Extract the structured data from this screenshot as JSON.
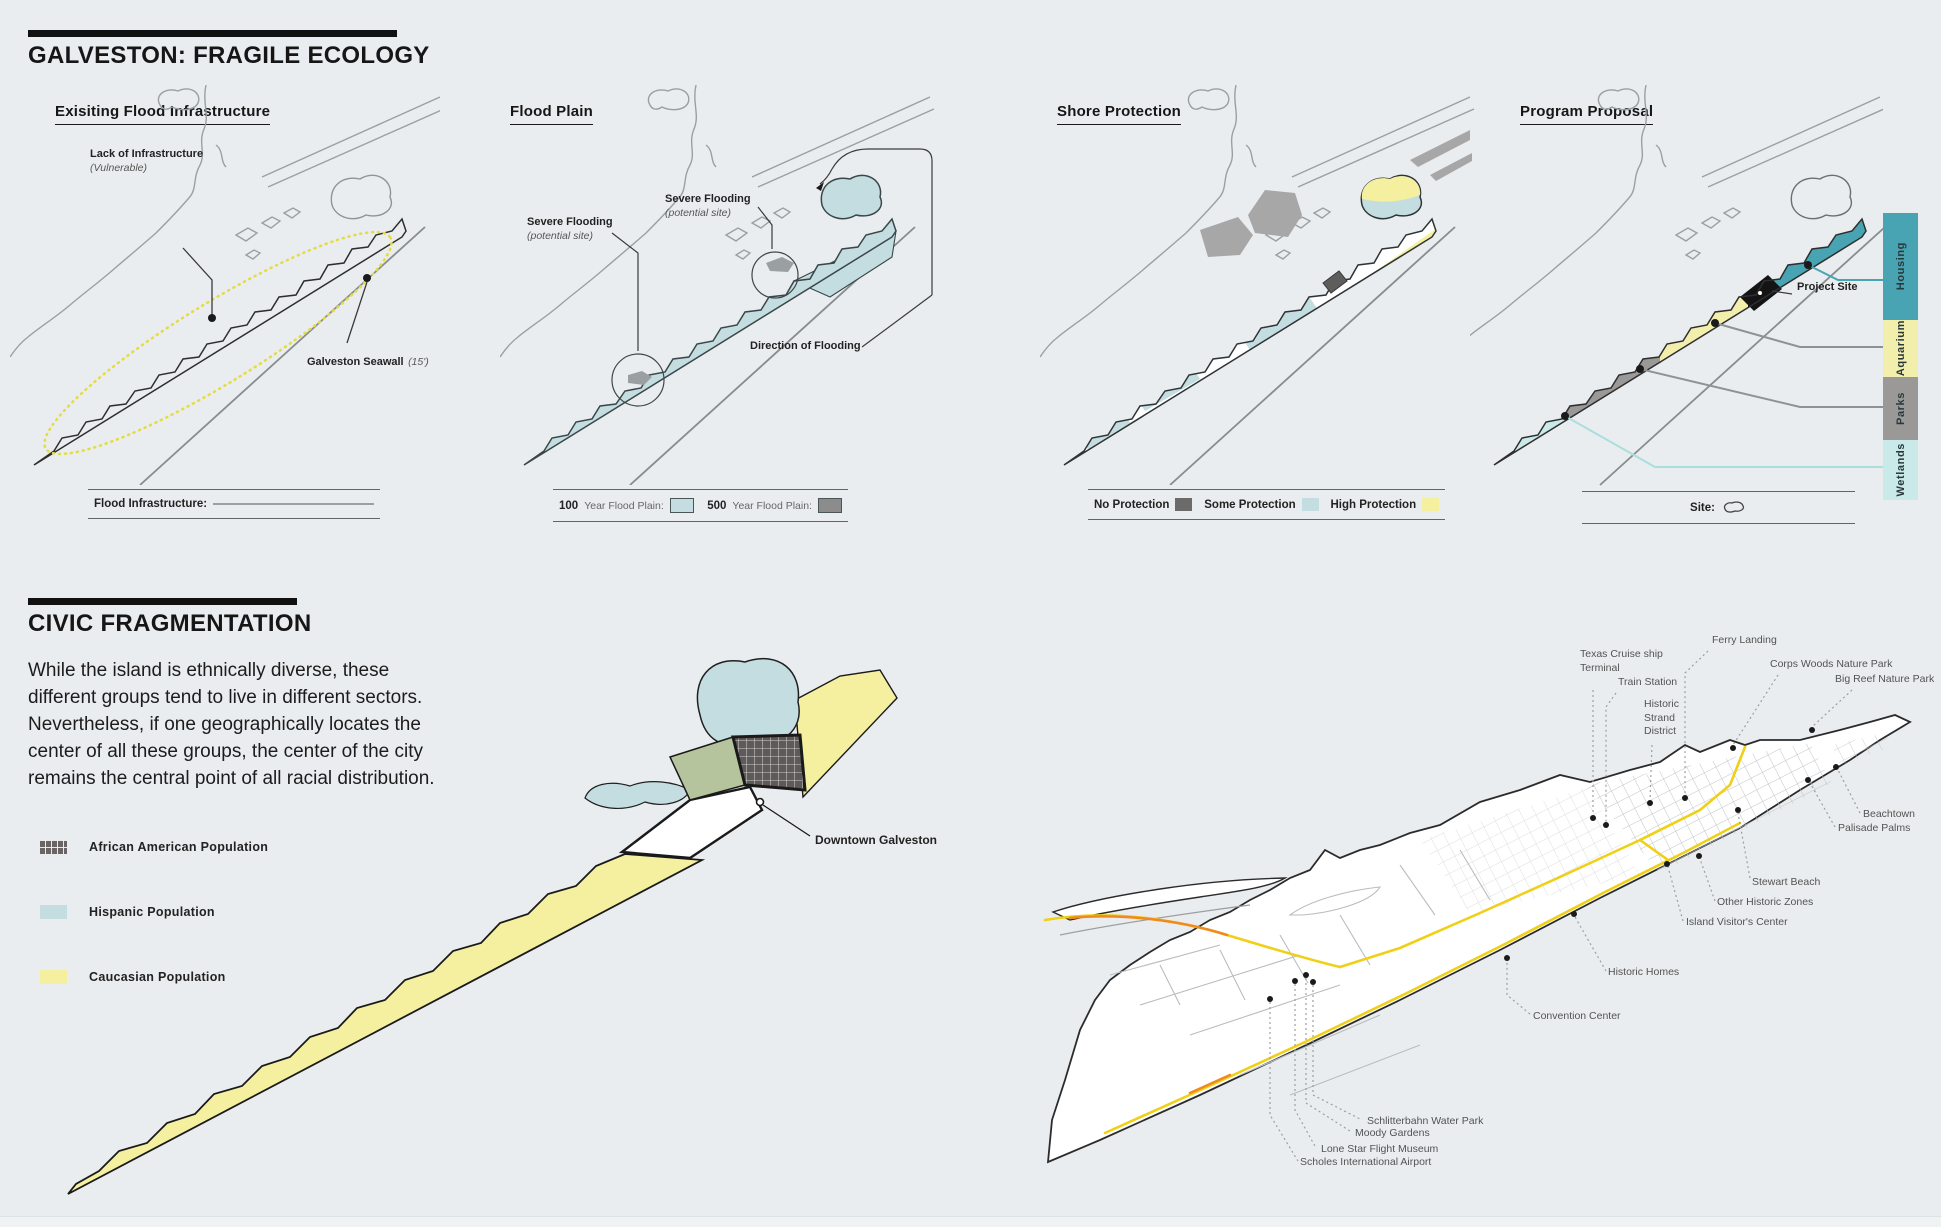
{
  "page": {
    "bg": "#eaedef"
  },
  "ecology": {
    "title": "GALVESTON: FRAGILE ECOLOGY",
    "flood_infrastructure": {
      "title": "Exisiting Flood Infrastructure",
      "lack_label": "Lack of Infrastructure",
      "lack_note": "(Vulnerable)",
      "seawall_label": "Galveston Seawall",
      "seawall_note": "(15')",
      "legend_label": "Flood Infrastructure:"
    },
    "flood_plain": {
      "title": "Flood Plain",
      "severe_label": "Severe Flooding",
      "severe_note": "(potential site)",
      "severe2_label": "Severe Flooding",
      "severe2_note": "(potential site)",
      "direction_label": "Direction of Flooding",
      "legend": [
        {
          "num": "100",
          "label": "Year Flood Plain:",
          "color": "#c3dde0"
        },
        {
          "num": "500",
          "label": "Year Flood Plain:",
          "color": "#8c8c8c"
        }
      ]
    },
    "shore_protection": {
      "title": "Shore Protection",
      "legend": [
        {
          "label": "No Protection",
          "color": "#6d6a6a"
        },
        {
          "label": "Some Protection",
          "color": "#c3dde0"
        },
        {
          "label": "High Protection",
          "color": "#f4f09f"
        }
      ]
    },
    "program_proposal": {
      "title": "Program Proposal",
      "project_site_label": "Project Site",
      "site_label": "Site:",
      "programs": [
        {
          "label": "Housing",
          "color": "#48a4b2"
        },
        {
          "label": "Aquarium",
          "color": "#f2efad"
        },
        {
          "label": "Parks",
          "color": "#9b9898"
        },
        {
          "label": "Wetlands",
          "color": "#c9eae9"
        }
      ]
    }
  },
  "fragmentation": {
    "title": "CIVIC FRAGMENTATION",
    "paragraph": "While the island is ethnically diverse, these\ndifferent groups tend to live in different sectors.\nNevertheless, if one geographically locates the\ncenter of all these groups, the center of the city\nremains the central point of all racial distribution.",
    "legend": [
      {
        "label": "African American Population",
        "color": "#6a6464",
        "pattern": "grid"
      },
      {
        "label": "Hispanic Population",
        "color": "#c3dde0"
      },
      {
        "label": "Caucasian Population",
        "color": "#f4f09f"
      }
    ],
    "downtown_label": "Downtown Galveston"
  },
  "city_map": {
    "road_color": "#f0d017",
    "highlight_color": "#ef8a1f",
    "labels": {
      "ferry_landing": "Ferry Landing",
      "cruise_terminal": "Texas Cruise ship\nTerminal",
      "train_station": "Train Station",
      "strand_district": "Historic\nStrand\nDistrict",
      "corps_woods": "Corps Woods Nature Park",
      "big_reef": "Big Reef Nature Park",
      "beachtown": "Beachtown",
      "palisade_palms": "Palisade Palms",
      "stewart_beach": "Stewart Beach",
      "other_historic": "Other Historic Zones",
      "visitor_center": "Island Visitor's Center",
      "historic_homes": "Historic Homes",
      "convention_center": "Convention Center",
      "schlitterbahn": "Schlitterbahn Water Park",
      "moody_gardens": "Moody Gardens",
      "lone_star": "Lone Star Flight Museum",
      "scholes_airport": "Scholes International Airport"
    }
  }
}
